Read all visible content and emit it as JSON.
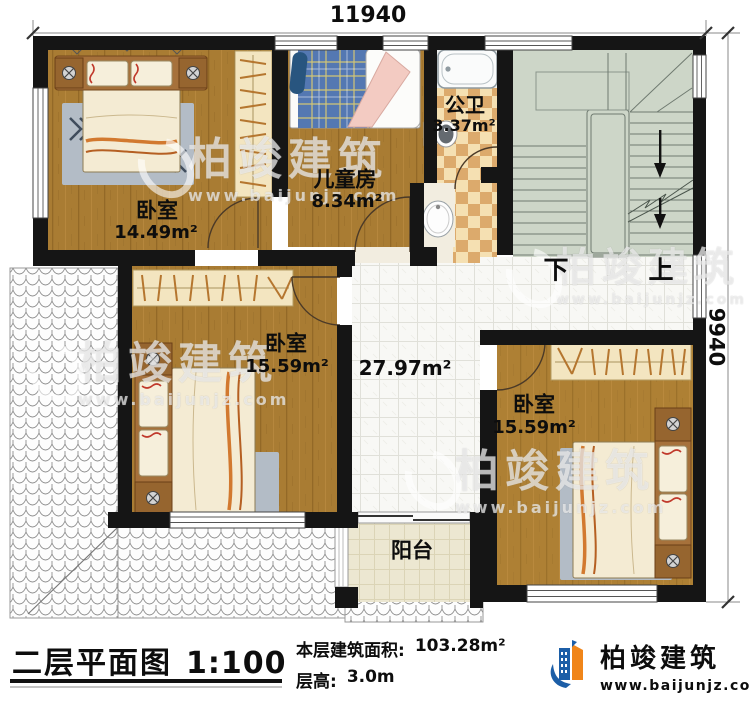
{
  "dimensions": {
    "top": "11940",
    "right": "9940"
  },
  "rooms": {
    "bedroom1": {
      "name": "卧室",
      "area": "14.49m²"
    },
    "kids": {
      "name": "儿童房",
      "area": "8.34m²"
    },
    "bath": {
      "name": "公卫",
      "area": "3.37m²"
    },
    "bedroom2": {
      "name": "卧室",
      "area": "15.59m²"
    },
    "hall": {
      "area": "27.97m²"
    },
    "bedroom3": {
      "name": "卧室",
      "area": "15.59m²"
    },
    "balcony": {
      "name": "阳台"
    }
  },
  "stairs": {
    "down": "下",
    "up": "上"
  },
  "title": {
    "plan_name": "二层平面图",
    "scale": "1:100",
    "area_label": "本层建筑面积:",
    "area_value": "103.28m²",
    "height_label": "层高:",
    "height_value": "3.0m"
  },
  "brand": {
    "name": "柏竣建筑",
    "url": "www.baijunjz.com"
  },
  "watermark": {
    "name": "柏竣建筑",
    "url": "www.baijunjz.com"
  },
  "colors": {
    "wall": "#151515",
    "wood": "#a97c33",
    "stair": "#cdd6c8",
    "accent_blue": "#1c5ea7",
    "accent_orange": "#f08519"
  }
}
